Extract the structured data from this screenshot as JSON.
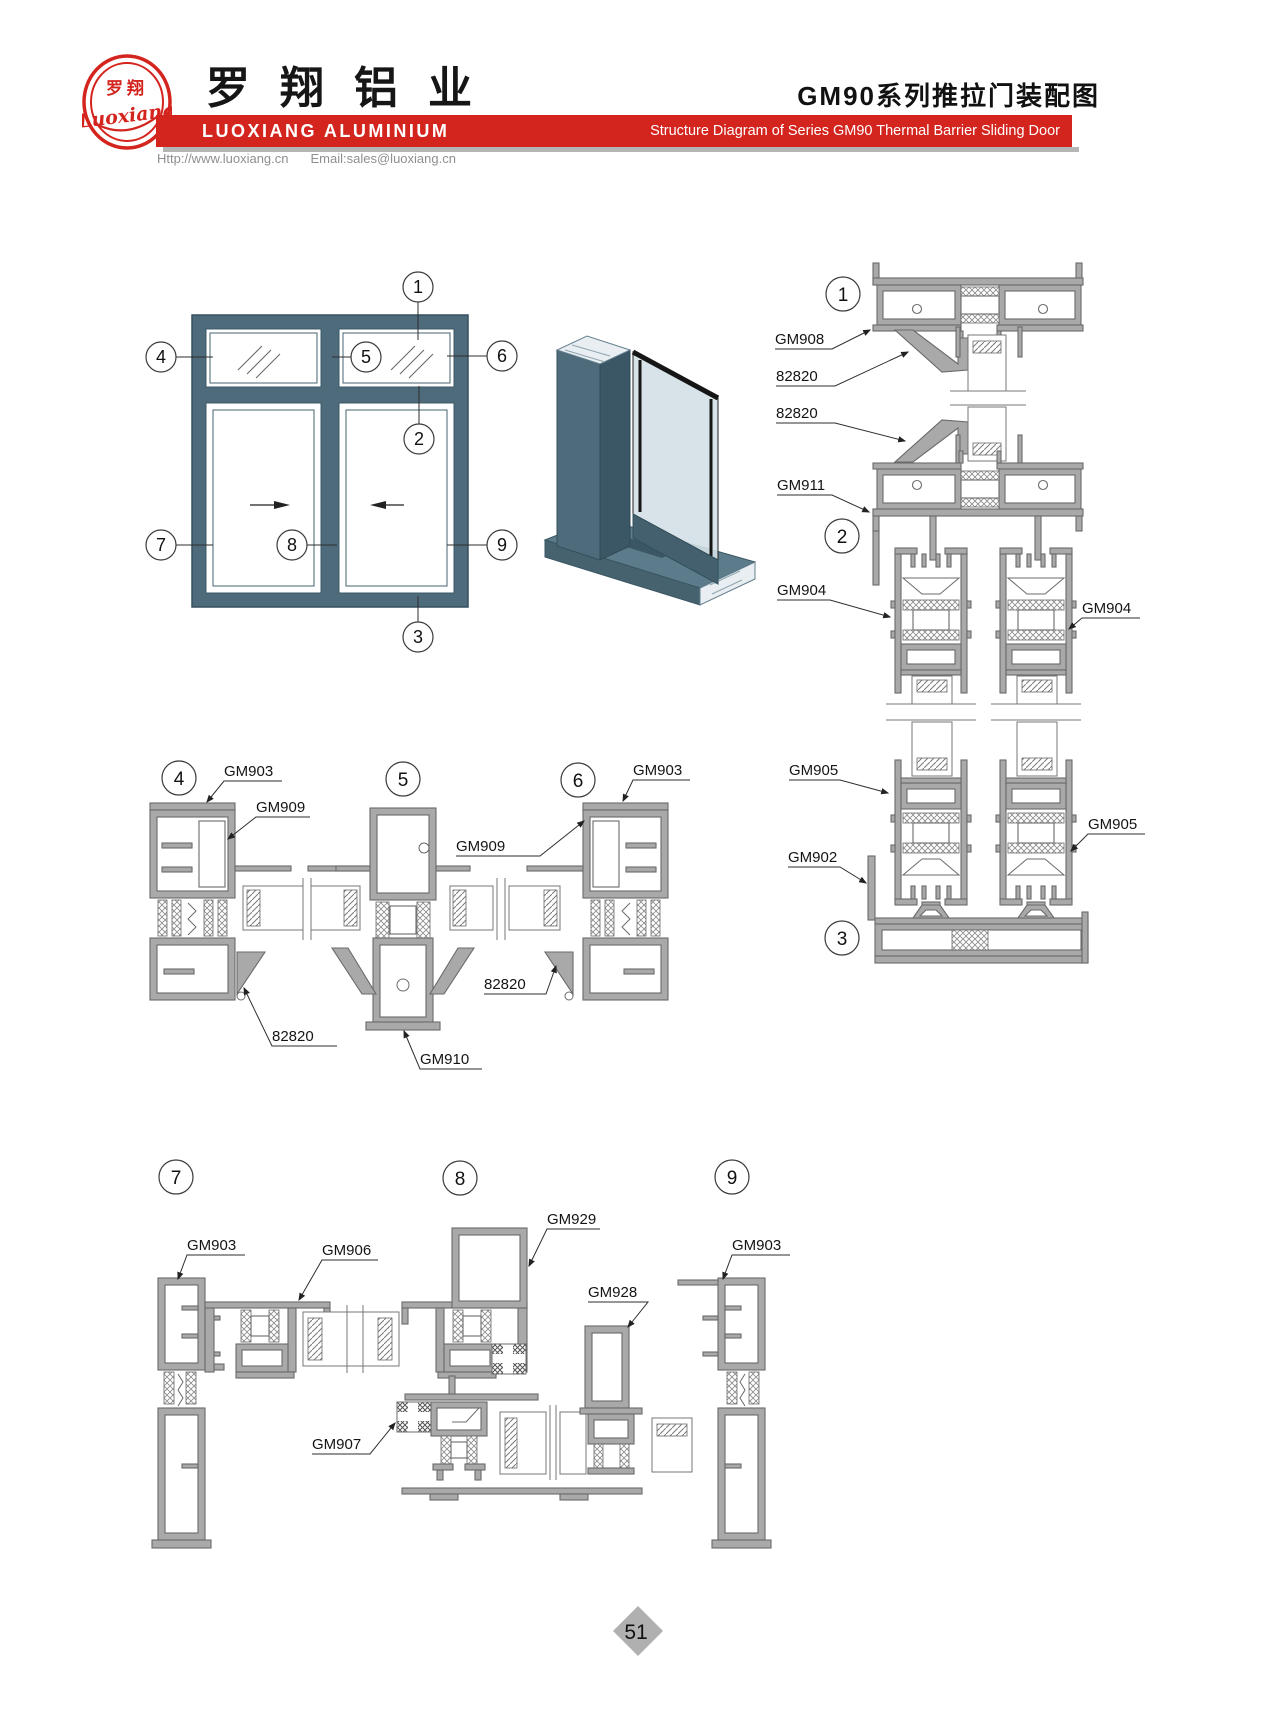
{
  "header": {
    "logo": {
      "cn": "罗翔",
      "script": "Luoxiang"
    },
    "company_cn": "罗翔铝业",
    "company_en": "LUOXIANG ALUMINIUM",
    "website": "Http://www.luoxiang.cn",
    "email": "Email:sales@luoxiang.cn",
    "title_cn": "GM90系列推拉门装配图",
    "title_en": "Structure Diagram of Series GM90 Thermal Barrier Sliding Door"
  },
  "colors": {
    "accent": "#d4241e",
    "frame": "#4e6b7c",
    "metal": "#a9a9a9",
    "shadow": "#b5b5b5"
  },
  "sections": {
    "s1": {
      "id": "1",
      "labels": [
        "GM908",
        "82820",
        "82820"
      ]
    },
    "s2": {
      "id": "2",
      "labels": [
        "GM911",
        "GM904",
        "GM904"
      ]
    },
    "s3": {
      "id": "3",
      "labels": [
        "GM905",
        "GM905",
        "GM902"
      ]
    },
    "s4": {
      "id": "4",
      "labels": [
        "GM903",
        "GM909",
        "82820"
      ]
    },
    "s5": {
      "id": "5",
      "labels": [
        "GM910"
      ]
    },
    "s6": {
      "id": "6",
      "labels": [
        "GM903",
        "GM909",
        "82820"
      ]
    },
    "s7": {
      "id": "7",
      "labels": [
        "GM903",
        "GM906"
      ]
    },
    "s8": {
      "id": "8",
      "labels": [
        "GM929",
        "GM907"
      ]
    },
    "s9": {
      "id": "9",
      "labels": [
        "GM928",
        "GM903"
      ]
    }
  },
  "footer": {
    "page_number": "51"
  }
}
